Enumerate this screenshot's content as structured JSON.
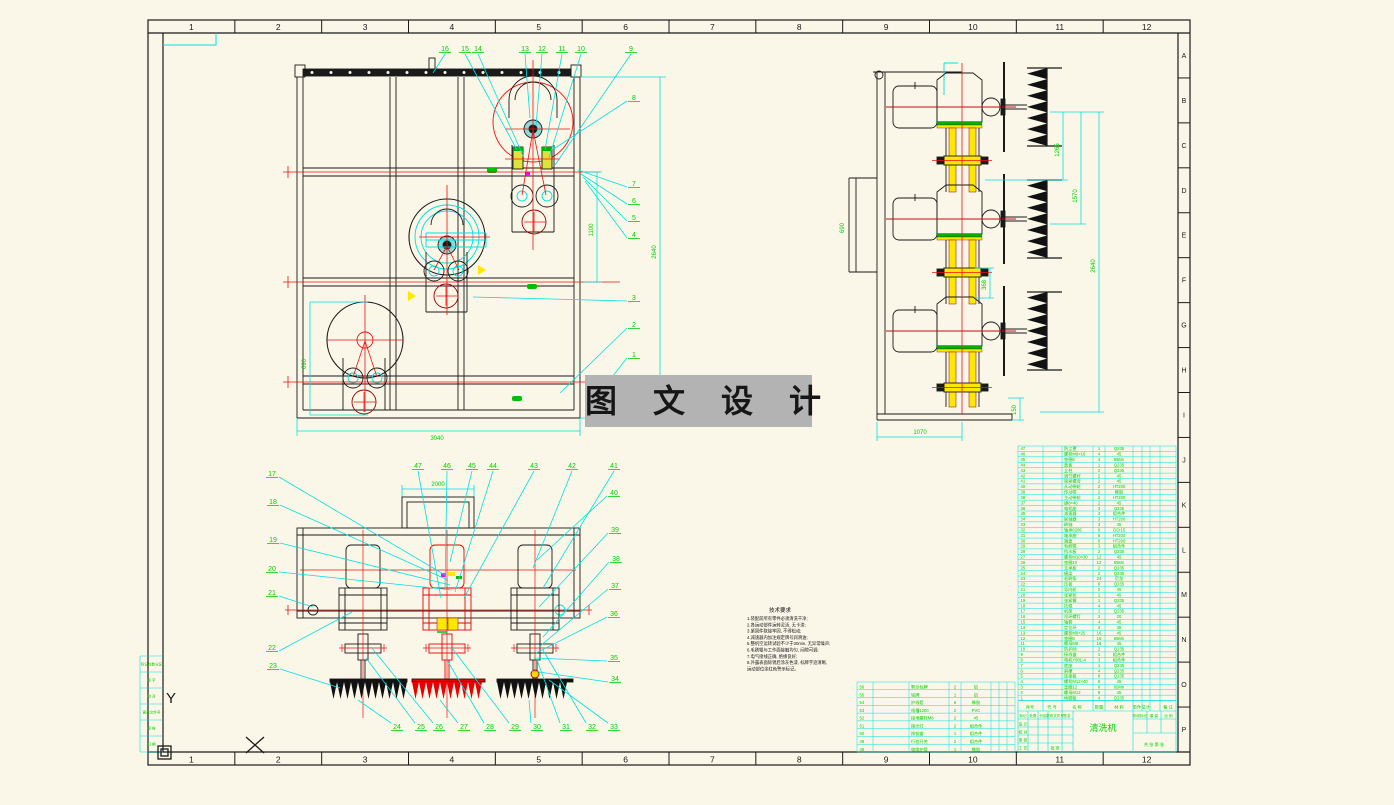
{
  "sheet": {
    "bg": "#faf7e8",
    "ruler_top": [
      "1",
      "2",
      "3",
      "4",
      "5",
      "6",
      "7",
      "8",
      "9",
      "10",
      "11",
      "12"
    ],
    "ruler_bottom": [
      "1",
      "2",
      "3",
      "4",
      "5",
      "6",
      "7",
      "8",
      "9",
      "10",
      "11",
      "12"
    ],
    "ruler_right": [
      "A",
      "B",
      "C",
      "D",
      "E",
      "F",
      "G",
      "H",
      "I",
      "J",
      "K",
      "L",
      "M",
      "N",
      "O",
      "P"
    ]
  },
  "colors": {
    "paper": "#faf7e8",
    "line": "#1a1a1a",
    "cyan": "#00e0e0",
    "green": "#00cf00",
    "red": "#f01010",
    "darkred": "#990000",
    "yellow": "#ffe800",
    "magenta": "#ff00ff",
    "teal_fill": "#8fd8d8",
    "watermark_bg": "#b3b3b3"
  },
  "watermark": {
    "text": "图 文 设 计"
  },
  "ucs": {
    "y_label": "Y",
    "x_label": "X"
  },
  "dims": {
    "front_bottom": "3040",
    "front_height": "2640",
    "front_rail": "1100",
    "front_left": "690",
    "side_left": "690",
    "side_d1": "1265",
    "side_d2": "1570",
    "side_d3": "2640",
    "side_flange": "368",
    "side_foot": "150",
    "side_bottom": "1070",
    "bottom_top": "2000"
  },
  "callouts": {
    "front_top": [
      {
        "t": "16",
        "x": 445,
        "y": 51,
        "tx": 433,
        "ty": 73
      },
      {
        "t": "15",
        "x": 465,
        "y": 51,
        "tx": 517,
        "ty": 150
      },
      {
        "t": "14",
        "x": 478,
        "y": 51,
        "tx": 524,
        "ty": 158
      },
      {
        "t": "13",
        "x": 525,
        "y": 51,
        "tx": 530,
        "ty": 118
      },
      {
        "t": "12",
        "x": 542,
        "y": 51,
        "tx": 536,
        "ty": 126
      },
      {
        "t": "11",
        "x": 562,
        "y": 51,
        "tx": 545,
        "ty": 150
      },
      {
        "t": "10",
        "x": 581,
        "y": 51,
        "tx": 549,
        "ty": 158
      },
      {
        "t": "9",
        "x": 631,
        "y": 51,
        "tx": 555,
        "ty": 165
      }
    ],
    "front_right": [
      {
        "t": "8",
        "x": 634,
        "y": 100,
        "tx": 552,
        "ty": 150
      },
      {
        "t": "7",
        "x": 634,
        "y": 186,
        "tx": 578,
        "ty": 170
      },
      {
        "t": "6",
        "x": 634,
        "y": 203,
        "tx": 581,
        "ty": 174
      },
      {
        "t": "5",
        "x": 634,
        "y": 220,
        "tx": 583,
        "ty": 177
      },
      {
        "t": "4",
        "x": 634,
        "y": 237,
        "tx": 585,
        "ty": 181
      },
      {
        "t": "3",
        "x": 634,
        "y": 300,
        "tx": 473,
        "ty": 297
      },
      {
        "t": "2",
        "x": 634,
        "y": 327,
        "tx": 560,
        "ty": 393
      },
      {
        "t": "1",
        "x": 634,
        "y": 357,
        "tx": 586,
        "ty": 410
      }
    ],
    "bl_left": [
      {
        "t": "17",
        "x": 272,
        "y": 476,
        "tx": 445,
        "ty": 575
      },
      {
        "t": "18",
        "x": 273,
        "y": 504,
        "tx": 448,
        "ty": 580
      },
      {
        "t": "19",
        "x": 273,
        "y": 542,
        "tx": 450,
        "ty": 585
      },
      {
        "t": "20",
        "x": 272,
        "y": 571,
        "tx": 452,
        "ty": 590
      },
      {
        "t": "21",
        "x": 272,
        "y": 595,
        "tx": 313,
        "ty": 607
      },
      {
        "t": "22",
        "x": 272,
        "y": 650,
        "tx": 352,
        "ty": 612
      },
      {
        "t": "23",
        "x": 273,
        "y": 668,
        "tx": 340,
        "ty": 688
      }
    ],
    "bl_top": [
      {
        "t": "47",
        "x": 418,
        "y": 468,
        "tx": 441,
        "ty": 598
      },
      {
        "t": "46",
        "x": 447,
        "y": 468,
        "tx": 445,
        "ty": 590
      },
      {
        "t": "45",
        "x": 472,
        "y": 468,
        "tx": 450,
        "ty": 562
      },
      {
        "t": "44",
        "x": 493,
        "y": 468,
        "tx": 455,
        "ty": 592
      },
      {
        "t": "43",
        "x": 534,
        "y": 468,
        "tx": 464,
        "ty": 598
      },
      {
        "t": "42",
        "x": 572,
        "y": 468,
        "tx": 533,
        "ty": 568
      },
      {
        "t": "41",
        "x": 614,
        "y": 468,
        "tx": 543,
        "ty": 588
      }
    ],
    "bl_right": [
      {
        "t": "40",
        "x": 614,
        "y": 495,
        "tx": 537,
        "ty": 560
      },
      {
        "t": "39",
        "x": 615,
        "y": 532,
        "tx": 539,
        "ty": 607
      },
      {
        "t": "38",
        "x": 616,
        "y": 561,
        "tx": 543,
        "ty": 637
      },
      {
        "t": "37",
        "x": 615,
        "y": 588,
        "tx": 539,
        "ty": 647
      },
      {
        "t": "36",
        "x": 614,
        "y": 616,
        "tx": 536,
        "ty": 653
      },
      {
        "t": "35",
        "x": 614,
        "y": 660,
        "tx": 534,
        "ty": 658
      },
      {
        "t": "34",
        "x": 615,
        "y": 681,
        "tx": 532,
        "ty": 671
      }
    ],
    "bl_bottom": [
      {
        "t": "24",
        "x": 397,
        "y": 729,
        "tx": 358,
        "ty": 700
      },
      {
        "t": "25",
        "x": 421,
        "y": 729,
        "tx": 366,
        "ty": 658
      },
      {
        "t": "26",
        "x": 439,
        "y": 729,
        "tx": 371,
        "ty": 647
      },
      {
        "t": "27",
        "x": 464,
        "y": 729,
        "tx": 440,
        "ty": 700
      },
      {
        "t": "28",
        "x": 490,
        "y": 729,
        "tx": 447,
        "ty": 660
      },
      {
        "t": "29",
        "x": 515,
        "y": 729,
        "tx": 452,
        "ty": 648
      },
      {
        "t": "30",
        "x": 537,
        "y": 729,
        "tx": 529,
        "ty": 700
      },
      {
        "t": "31",
        "x": 566,
        "y": 729,
        "tx": 537,
        "ty": 660
      },
      {
        "t": "32",
        "x": 592,
        "y": 729,
        "tx": 543,
        "ty": 650
      },
      {
        "t": "33",
        "x": 614,
        "y": 729,
        "tx": 549,
        "ty": 680
      }
    ]
  },
  "notes": {
    "title": "技术要求",
    "lines": [
      "1.装配前所有零件必须清洗干净;",
      "2.各运动部件运转灵活, 无卡滞;",
      "3.紧固件联接牢固, 不得松动;",
      "4.减速器内加注规定牌号润滑油;",
      "5.整机空运转试验不少于30min, 无异常噪声;",
      "6.毛刷辊与工作面接触均匀, 间隙可调;",
      "7.电气接线正确, 绝缘良好;",
      "8.外露表面除锈后涂灰色漆, 标牌字迹清晰,",
      "   运动部位涂红色警示标记。"
    ]
  },
  "bom_main": {
    "rows": [
      {
        "no": "47",
        "name": "防尘罩",
        "qty": "1",
        "mtl": "Q235"
      },
      {
        "no": "46",
        "name": "螺栓M6×16",
        "qty": "4",
        "mtl": "45"
      },
      {
        "no": "45",
        "name": "垫圈6",
        "qty": "4",
        "mtl": "65Mn"
      },
      {
        "no": "44",
        "name": "盖板",
        "qty": "1",
        "mtl": "Q235"
      },
      {
        "no": "43",
        "name": "立柱",
        "qty": "2",
        "mtl": "Q235"
      },
      {
        "no": "42",
        "name": "调节螺杆",
        "qty": "2",
        "mtl": "45"
      },
      {
        "no": "41",
        "name": "锁紧螺母",
        "qty": "2",
        "mtl": "45"
      },
      {
        "no": "40",
        "name": "从动带轮",
        "qty": "2",
        "mtl": "HT200"
      },
      {
        "no": "39",
        "name": "传动带",
        "qty": "2",
        "mtl": "橡胶"
      },
      {
        "no": "38",
        "name": "主动带轮",
        "qty": "2",
        "mtl": "HT200"
      },
      {
        "no": "37",
        "name": "键8×40",
        "qty": "2",
        "mtl": "45"
      },
      {
        "no": "36",
        "name": "电机座",
        "qty": "3",
        "mtl": "Q235"
      },
      {
        "no": "35",
        "name": "减速器",
        "qty": "3",
        "mtl": "组合件"
      },
      {
        "no": "34",
        "name": "联轴器",
        "qty": "3",
        "mtl": "HT200"
      },
      {
        "no": "33",
        "name": "刷轴",
        "qty": "3",
        "mtl": "45"
      },
      {
        "no": "32",
        "name": "轴承6206",
        "qty": "6",
        "mtl": "GCr15"
      },
      {
        "no": "31",
        "name": "轴承座",
        "qty": "6",
        "mtl": "HT200"
      },
      {
        "no": "30",
        "name": "端盖",
        "qty": "6",
        "mtl": "HT200"
      },
      {
        "no": "29",
        "name": "毛刷辊",
        "qty": "3",
        "mtl": "组合件"
      },
      {
        "no": "28",
        "name": "挡水板",
        "qty": "2",
        "mtl": "Q235"
      },
      {
        "no": "27",
        "name": "螺栓M10×30",
        "qty": "12",
        "mtl": "45"
      },
      {
        "no": "26",
        "name": "垫圈10",
        "qty": "12",
        "mtl": "65Mn"
      },
      {
        "no": "25",
        "name": "支承板",
        "qty": "2",
        "mtl": "Q235"
      },
      {
        "no": "24",
        "name": "横梁",
        "qty": "2",
        "mtl": "Q235"
      },
      {
        "no": "23",
        "name": "毛刷条",
        "qty": "24",
        "mtl": "尼龙"
      },
      {
        "no": "22",
        "name": "压板",
        "qty": "6",
        "mtl": "Q235"
      },
      {
        "no": "21",
        "name": "导向轮",
        "qty": "2",
        "mtl": "45"
      },
      {
        "no": "20",
        "name": "张紧轮",
        "qty": "1",
        "mtl": "45"
      },
      {
        "no": "19",
        "name": "张紧臂",
        "qty": "1",
        "mtl": "Q235"
      },
      {
        "no": "18",
        "name": "托辊",
        "qty": "4",
        "mtl": "45"
      },
      {
        "no": "17",
        "name": "机架",
        "qty": "1",
        "mtl": "Q235"
      },
      {
        "no": "16",
        "name": "吊环螺钉",
        "qty": "2",
        "mtl": "20"
      },
      {
        "no": "15",
        "name": "轴套",
        "qty": "4",
        "mtl": "45"
      },
      {
        "no": "14",
        "name": "定位环",
        "qty": "4",
        "mtl": "45"
      },
      {
        "no": "13",
        "name": "螺栓M8×25",
        "qty": "16",
        "mtl": "45"
      },
      {
        "no": "12",
        "name": "垫圈8",
        "qty": "16",
        "mtl": "65Mn"
      },
      {
        "no": "11",
        "name": "螺母M8",
        "qty": "16",
        "mtl": "45"
      },
      {
        "no": "10",
        "name": "防护网",
        "qty": "2",
        "mtl": "Q235"
      },
      {
        "no": "9",
        "name": "接线盒",
        "qty": "1",
        "mtl": "组合件"
      },
      {
        "no": "8",
        "name": "电机Y90L-4",
        "qty": "3",
        "mtl": "组合件"
      },
      {
        "no": "7",
        "name": "底座",
        "qty": "1",
        "mtl": "Q235"
      },
      {
        "no": "6",
        "name": "斜撑",
        "qty": "4",
        "mtl": "Q235"
      },
      {
        "no": "5",
        "name": "连接板",
        "qty": "8",
        "mtl": "Q235"
      },
      {
        "no": "4",
        "name": "螺栓M12×40",
        "qty": "8",
        "mtl": "45"
      },
      {
        "no": "3",
        "name": "垫圈12",
        "qty": "8",
        "mtl": "65Mn"
      },
      {
        "no": "2",
        "name": "螺母M12",
        "qty": "8",
        "mtl": "45"
      },
      {
        "no": "1",
        "name": "地脚板",
        "qty": "4",
        "mtl": "Q235"
      }
    ]
  },
  "bom_aux": {
    "rows": [
      {
        "no": "56",
        "name": "警示标牌",
        "qty": "2",
        "mtl": "铝"
      },
      {
        "no": "55",
        "name": "铭牌",
        "qty": "1",
        "mtl": "铝"
      },
      {
        "no": "54",
        "name": "护线套",
        "qty": "6",
        "mtl": "橡胶"
      },
      {
        "no": "53",
        "name": "线槽1200",
        "qty": "2",
        "mtl": "PVC"
      },
      {
        "no": "52",
        "name": "接地螺栓M8",
        "qty": "2",
        "mtl": "45"
      },
      {
        "no": "51",
        "name": "指示灯",
        "qty": "2",
        "mtl": "组合件"
      },
      {
        "no": "50",
        "name": "按钮盒",
        "qty": "1",
        "mtl": "组合件"
      },
      {
        "no": "49",
        "name": "行程开关",
        "qty": "2",
        "mtl": "组合件"
      },
      {
        "no": "48",
        "name": "电缆护管",
        "qty": "1",
        "mtl": "橡胶"
      }
    ]
  },
  "title_block": {
    "product": "清洗机",
    "header": [
      "序号",
      "代 号",
      "名 称",
      "数量",
      "材 料",
      "单件",
      "总计",
      "备 注"
    ],
    "left_top_row": [
      "标记",
      "处数",
      "分区",
      "更改文件号",
      "签名"
    ],
    "left_rows": [
      "设 计",
      "校 对",
      "审 核",
      "工 艺"
    ],
    "left_extra": "批 准",
    "right_labels": [
      "阶段标记",
      "重 量",
      "比 例"
    ],
    "sheet_note": "共 张  第 张"
  },
  "revision_table": {
    "rows": [
      "标记处数分区",
      "签  字",
      "校  对",
      "更改文件号",
      "审  核",
      "日  期"
    ]
  }
}
